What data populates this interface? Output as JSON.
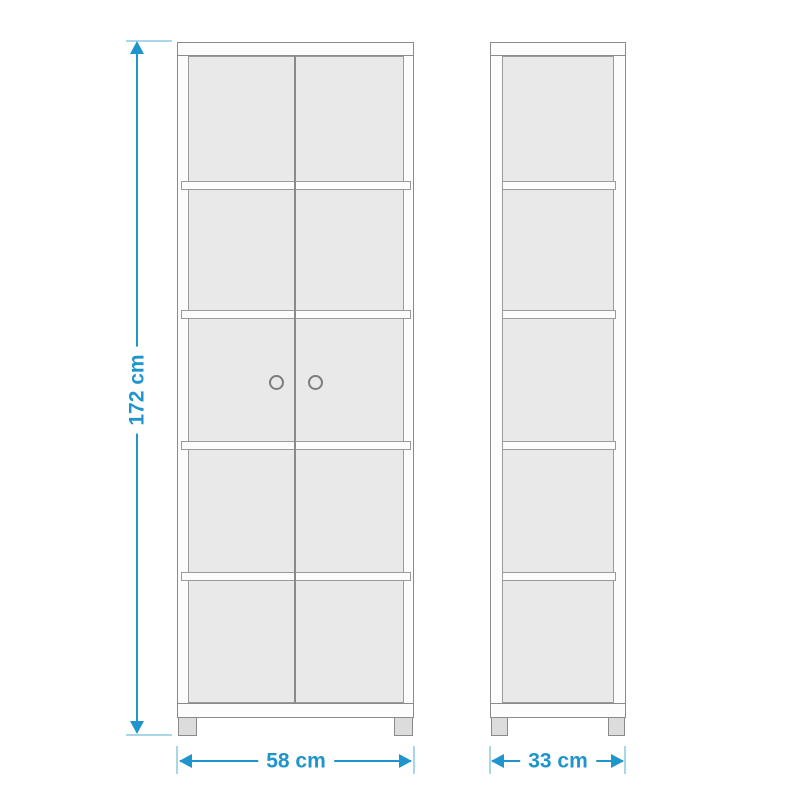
{
  "dimensions": {
    "height": {
      "label": "172 cm",
      "value": 172,
      "unit": "cm"
    },
    "width": {
      "label": "58 cm",
      "value": 58,
      "unit": "cm"
    },
    "depth": {
      "label": "33 cm",
      "value": 33,
      "unit": "cm"
    }
  },
  "structure": {
    "views": [
      "front",
      "side"
    ],
    "compartment_rows": 5,
    "doors": 2,
    "door_knobs": 2,
    "feet_per_view": 2
  },
  "colors": {
    "dim_blue": "#1e95cc",
    "tick_blue": "#a9d7ea",
    "outline": "#8a8a8a",
    "panel_border": "#9b9b9b",
    "panel_fill": "#e9e9e9",
    "frame_fill": "#fcfcfc",
    "feet_fill": "#dcdcdc",
    "background": "#ffffff"
  }
}
